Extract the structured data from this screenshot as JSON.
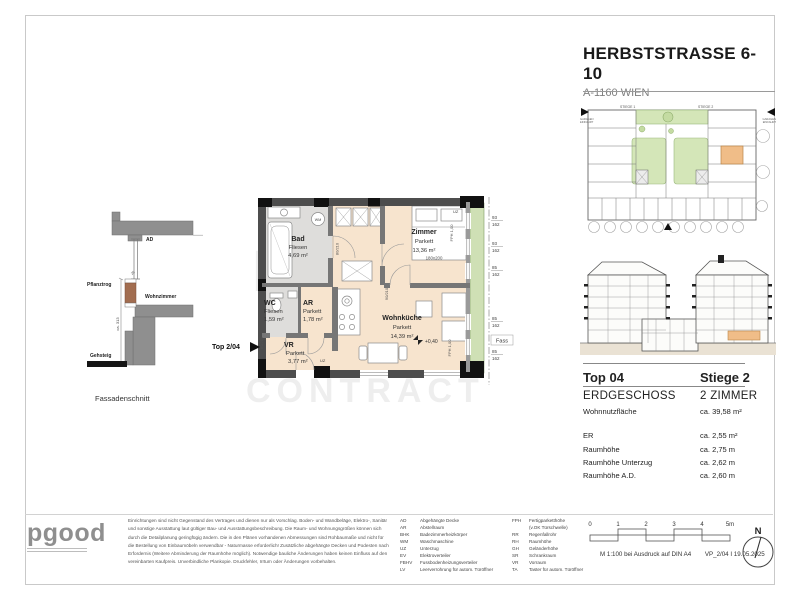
{
  "header": {
    "title": "HERBSTSTRASSE 6-10",
    "subtitle": "A-1160 WIEN"
  },
  "site_plan": {
    "stiege1": "STIEGE 1",
    "stiege2": "STIEGE 2",
    "garage_line1": "GARAGEN",
    "garage_line2": "EINFAHRT"
  },
  "facade": {
    "ad": "AD",
    "pflanztrog": "Pflanztrog",
    "wohnzimmer": "Wohnzimmer",
    "gehsteig": "Gehsteig",
    "height_dim": "ca. 313",
    "planter_dim": "25",
    "caption": "Fassadenschnitt"
  },
  "plan": {
    "top_marker": "Top 2/04",
    "rooms": {
      "bad": {
        "name": "Bad",
        "floor": "Fliesen",
        "area": "4,69 m²"
      },
      "zimmer": {
        "name": "Zimmer",
        "floor": "Parkett",
        "area": "13,36 m²"
      },
      "wc": {
        "name": "WC",
        "floor": "Fliesen",
        "area": "1,59 m²"
      },
      "ar": {
        "name": "AR",
        "floor": "Parkett",
        "area": "1,78 m²"
      },
      "vr": {
        "name": "VR",
        "floor": "Parkett",
        "area": "3,77 m²"
      },
      "wohnkueche": {
        "name": "Wohnküche",
        "floor": "Parkett",
        "area": "14,39 m²"
      }
    },
    "bed_size": "180x200",
    "level_marker": "+0,40",
    "wm_label": "WM",
    "uz_label": "UZ",
    "fph_label": "FPH 1,00",
    "fass_label": "Fass",
    "door_bad": "80/210",
    "door_zimmer": "90/210",
    "door_wc": "80/210",
    "windows": [
      {
        "w": "93",
        "h": "162"
      },
      {
        "w": "93",
        "h": "162"
      },
      {
        "w": "85",
        "h": "162"
      },
      {
        "w": "85",
        "h": "162"
      },
      {
        "w": "85",
        "h": "162"
      }
    ]
  },
  "info": {
    "top": "Top  04",
    "stiege": "Stiege 2",
    "floor": "ERDGESCHOSS",
    "type": "2 ZIMMER",
    "area_label": "Wohnnutzfläche",
    "area_value": "ca. 39,58 m²",
    "metrics": [
      {
        "label": "ER",
        "value": "ca. 2,55 m²"
      },
      {
        "label": "Raumhöhe",
        "value": "ca. 2,75 m"
      },
      {
        "label": "Raumhöhe Unterzug",
        "value": "ca. 2,62 m"
      },
      {
        "label": "Raumhöhe A.D.",
        "value": "ca. 2,60 m"
      }
    ]
  },
  "footer": {
    "logo": "pgood",
    "disclaimer": [
      "Einrichtungen sind nicht Gegenstand des Vertrages und dienen nur als Vorschlag. Boden- und Wandbeläge, Elektro-, Sanitär",
      "und sonstige Ausstattung laut gültiger Bau- und Ausstattungsbeschreibung. Die Raum- und Wohnungsgrößen können sich",
      "durch die Detailplanung geringfügig ändern. Die in den Plänen vorhandenen Abmessungen sind Rohbaumaße und nicht für",
      "die Bestellung von Einbaumöbeln verwendbar - Naturmasse erforderlich! Zusätzliche abgehängte Decken und Podesten nach",
      "Erfordernis (Weitere Abminderung der Raumhöhe möglich). Notwendige bauliche Änderungen haben keinen Einfluss auf den",
      "vereinbarten Kaufpreis. Unverbindliche Plankopie. Druckfehler, Irrtum oder Änderungen vorbehalten."
    ],
    "abbr_col1": [
      {
        "code": "AD",
        "label": "Abgehängte Decke"
      },
      {
        "code": "AR",
        "label": "Abstellraum"
      },
      {
        "code": "BHK",
        "label": "Badezimmerheizkörper"
      },
      {
        "code": "WM",
        "label": "Waschmaschine"
      },
      {
        "code": "UZ",
        "label": "Unterzug"
      },
      {
        "code": "EV",
        "label": "Elektroverteiler"
      },
      {
        "code": "FBHV",
        "label": "Fussbodenheizungsverteiler"
      },
      {
        "code": "LV",
        "label": "Leerverrohrung für autom. Türöffner"
      }
    ],
    "abbr_col2": [
      {
        "code": "FPH",
        "label": "Fertigparketthöhe"
      },
      {
        "code": "",
        "label": "(v.OK Türschwelle)"
      },
      {
        "code": "RR",
        "label": "Regenfallrohr"
      },
      {
        "code": "RH",
        "label": "Raumhöhe"
      },
      {
        "code": "GH",
        "label": "Geländerhöhe"
      },
      {
        "code": "SR",
        "label": "Schrankraum"
      },
      {
        "code": "VR",
        "label": "Vorraum"
      },
      {
        "code": "TA",
        "label": "Taster für autom. Türöffner"
      }
    ],
    "scale_ticks": [
      "0",
      "1",
      "2",
      "3",
      "4",
      "5m"
    ],
    "scale_note": "M 1:100 bei Ausdruck auf DIN A4",
    "plan_code": "VP_2/04 I 19.05.2025",
    "compass": "N"
  },
  "watermark": {
    "line1": "IMMO",
    "line2": "CONTRACT"
  },
  "colors": {
    "highlight_orange": "#f0bd88",
    "parquet": "#f7e4ce",
    "tiles": "#dedddb",
    "planter_green": "#cfe0b5",
    "wall_gray": "#4d4d4d"
  }
}
